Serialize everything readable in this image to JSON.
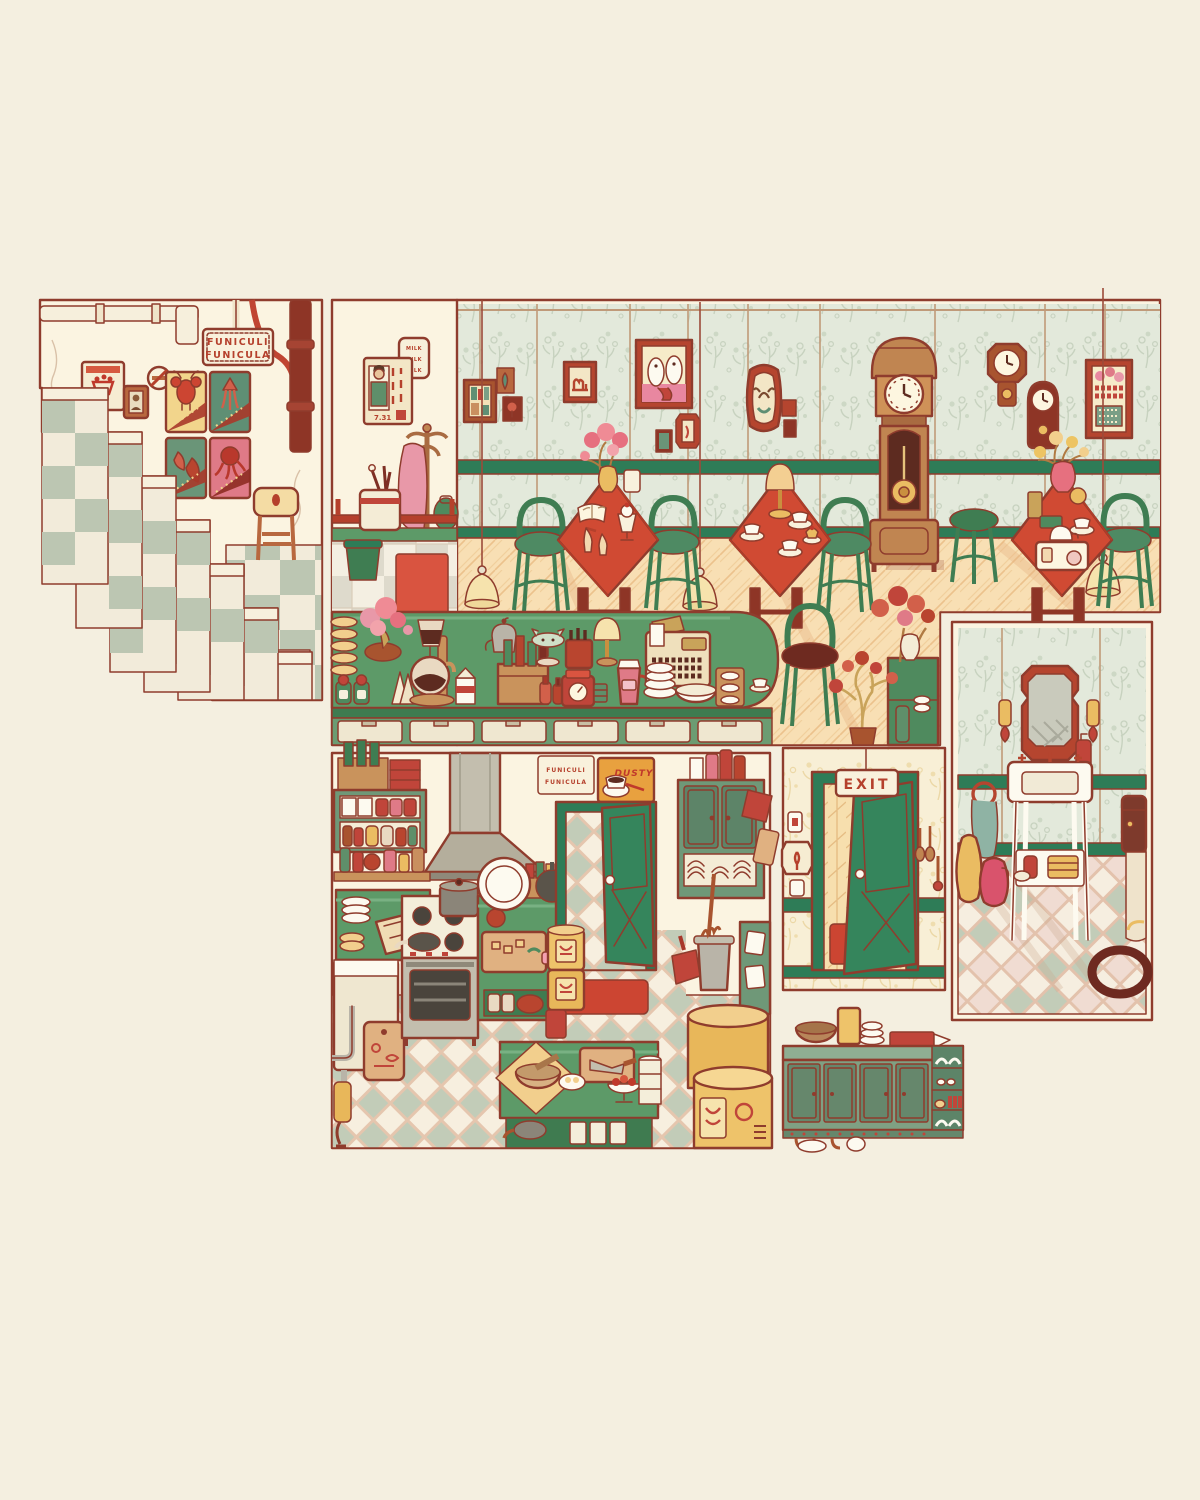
{
  "scene": {
    "type": "illustration",
    "subject": "retro cafe interior cutaway panels (stairwell, dining room, kitchen, exit hall, washroom, sideboard)",
    "background_color": "#f4efe0",
    "outline_color": "#8f3c2d",
    "palette": {
      "panel_cream": "#fbf4e1",
      "wallpaper_green": "#e3e9db",
      "wallpaper_sprig": "#c7d2bf",
      "wallpaper_cream": "#f8efd6",
      "rail_green": "#2e7c57",
      "counter_green": "#5d9a68",
      "cabinet_green": "#7fa083",
      "door_green": "#35855c",
      "accent_red": "#c64734",
      "table_red": "#d04a33",
      "deep_maroon": "#7e2f24",
      "wood": "#c08551",
      "parquet_yellow": "#f8dfb4",
      "tile_sage": "#c2ccb8",
      "tile_pink": "#f0dcd2",
      "lamp_yellow": "#f3cf92"
    },
    "texts": {
      "stair_sign_line1": "FUNICULI",
      "stair_sign_line2": "FUNICULA",
      "milk_sign_line1": "MILK",
      "milk_sign_line2": "MILK",
      "milk_sign_line3": "MILK",
      "poster_date": "7.31",
      "kitchen_card_line1": "FUNICULI",
      "kitchen_card_line2": "FUNICULA",
      "dusty_poster": "DUSTY",
      "exit_sign": "EXIT"
    }
  }
}
